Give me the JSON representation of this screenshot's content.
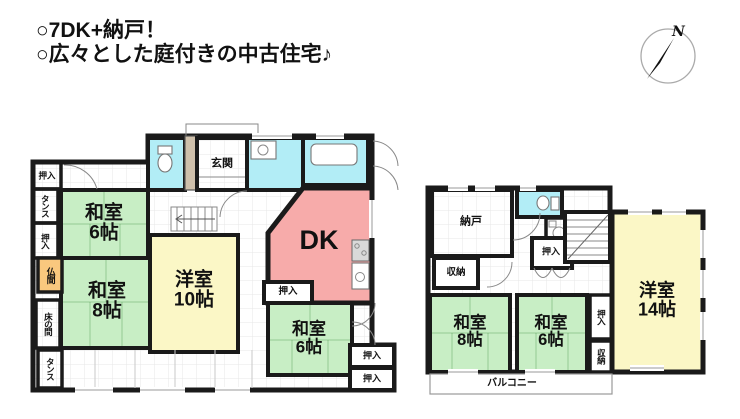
{
  "header": {
    "line1": "○7DK+納戸！",
    "line2": "○広々とした庭付きの中古住宅♪"
  },
  "compass": {
    "north_label": "N"
  },
  "colors": {
    "tatami_green": "#c8eec5",
    "wood_yellow": "#fbf7c6",
    "dk_pink": "#f7abaa",
    "water_cyan": "#b2edf6",
    "butsuma_orange": "#f9c87e",
    "wall_black": "#1a1a1a",
    "door_beige": "#cfc0ab"
  },
  "floor1": {
    "rooms": {
      "washitsu6a": {
        "name": "和室",
        "size": "6帖"
      },
      "washitsu8": {
        "name": "和室",
        "size": "8帖"
      },
      "yoshitsu10": {
        "name": "洋室",
        "size": "10帖"
      },
      "dk": {
        "name": "DK"
      },
      "washitsu6b": {
        "name": "和室",
        "size": "6帖"
      },
      "genkan": {
        "name": "玄関"
      }
    },
    "closets": {
      "oshiire_top_left": "押入",
      "tansu_upper": "タンス",
      "oshiire_left": "押入",
      "butsuma": "仏間",
      "tokonoma": "床の間",
      "tansu_lower": "タンス",
      "oshiire_center": "押入",
      "oshiire_right_upper": "押入",
      "oshiire_right_lower": "押入"
    }
  },
  "floor2": {
    "rooms": {
      "nando": {
        "name": "納戸"
      },
      "washitsu8": {
        "name": "和室",
        "size": "8帖"
      },
      "washitsu6": {
        "name": "和室",
        "size": "6帖"
      },
      "yoshitsu14": {
        "name": "洋室",
        "size": "14帖"
      }
    },
    "closets": {
      "shuno_left": "収納",
      "oshiire_center": "押入",
      "oshiire_right": "押入",
      "shuno_right": "収納"
    },
    "balcony": "バルコニー"
  }
}
